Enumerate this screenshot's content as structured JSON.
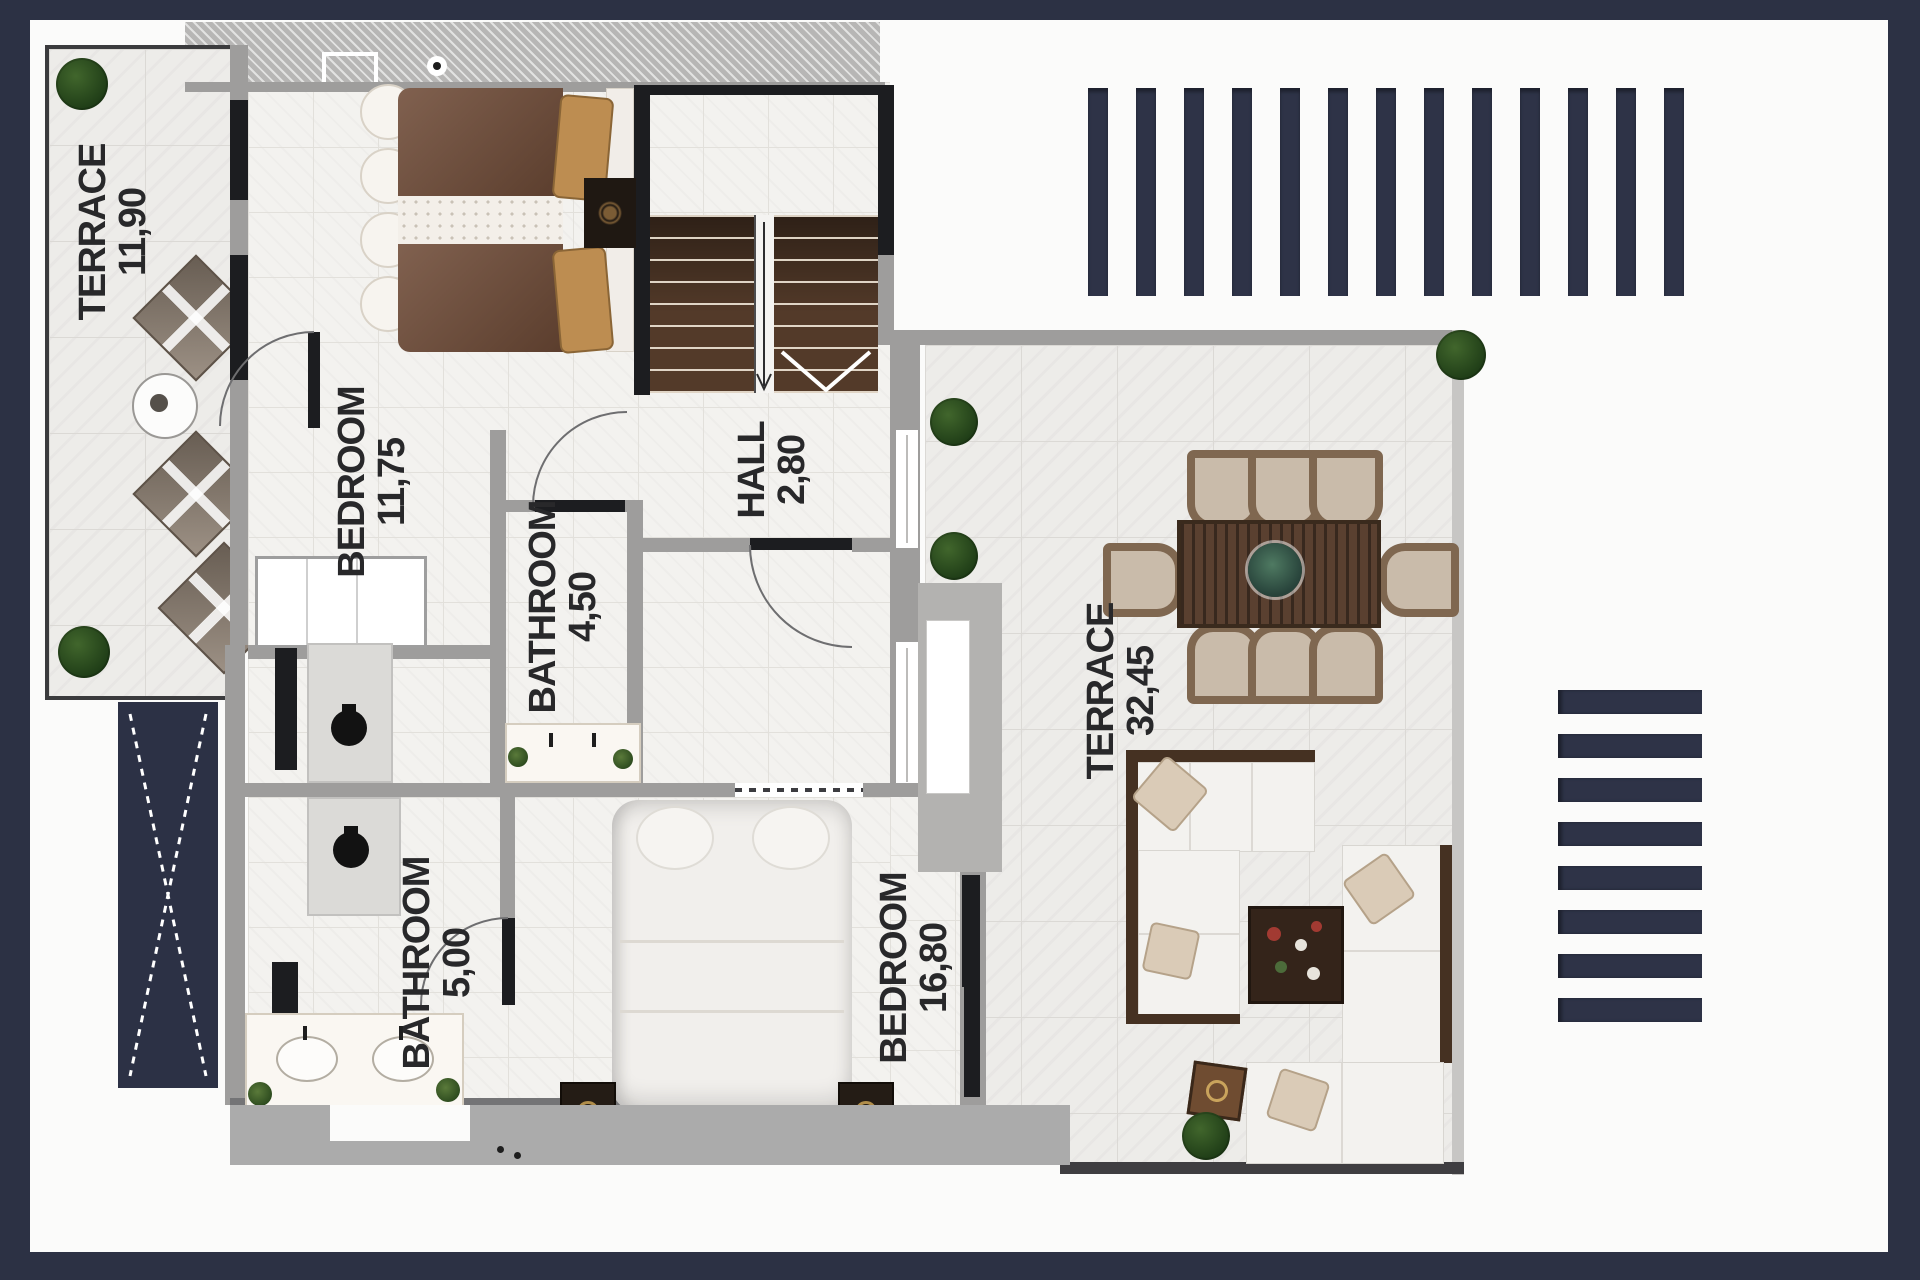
{
  "plan": {
    "type": "residential-floor-plan",
    "rooms": [
      {
        "id": "terrace-small",
        "name": "TERRACE",
        "area": "11,90"
      },
      {
        "id": "bedroom-1",
        "name": "BEDROOM",
        "area": "11,75"
      },
      {
        "id": "hall",
        "name": "HALL",
        "area": "2,80"
      },
      {
        "id": "bathroom-1",
        "name": "BATHROOM",
        "area": "4,50"
      },
      {
        "id": "bathroom-2",
        "name": "BATHROOM",
        "area": "5,00"
      },
      {
        "id": "bedroom-2",
        "name": "BEDROOM",
        "area": "16,80"
      },
      {
        "id": "terrace-large",
        "name": "TERRACE",
        "area": "32,45"
      }
    ],
    "colors": {
      "frame_navy": "#2c3144",
      "page_white": "#fbfbfa",
      "wall_gray": "#9e9d9c",
      "wall_black": "#1c1d20",
      "wood_brown": "#5a4030",
      "bed_brown": "#6f4b37",
      "pillow_tan": "#bd8d51",
      "bush_green": "#2c4a1e",
      "label_text": "#28282a"
    }
  }
}
